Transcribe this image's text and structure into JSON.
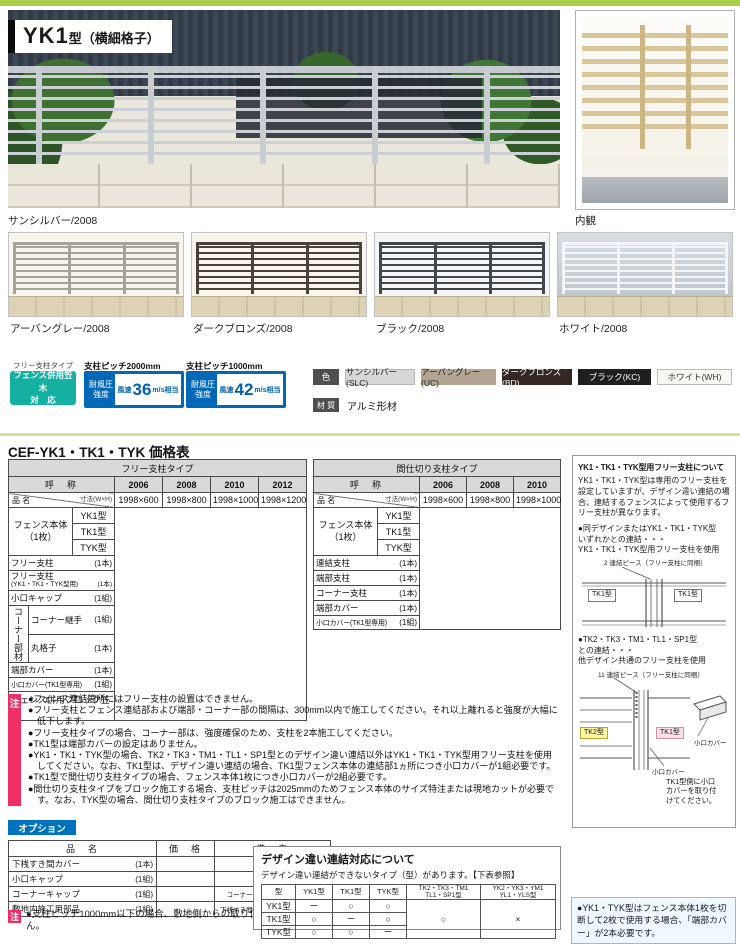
{
  "theme": {
    "top_bar_green": "#abce4b",
    "kasagi_teal": "#14b0a2",
    "wind_blue": "#0068b7",
    "note_red": "#ef2e63",
    "option_blue": "#0071bc",
    "kasagi_text_teal": "#00a3af"
  },
  "hero": {
    "model": "YK1",
    "model_suffix": "型（横細格子）",
    "caption": "サンシルバー/2008",
    "side_caption": "内観"
  },
  "variants": {
    "items": [
      {
        "label": "アーバングレー/2008"
      },
      {
        "label": "ダークブロンズ/2008"
      },
      {
        "label": "ブラック/2008"
      },
      {
        "label": "ホワイト/2008"
      }
    ]
  },
  "specs": {
    "free_post_type": "フリー支柱タイプ",
    "kasagi_badge": "フェンス併用笠木\n対　応",
    "wind": [
      {
        "pitch": "支柱ピッチ2000mm",
        "strength": "耐風圧\n強度",
        "prefix": "風速",
        "value": "36",
        "unit": "m/s相当"
      },
      {
        "pitch": "支柱ピッチ1000mm",
        "strength": "耐風圧\n強度",
        "prefix": "風速",
        "value": "42",
        "unit": "m/s相当"
      }
    ],
    "color_label": "色",
    "colors": [
      {
        "name": "サンシルバー(SLC)",
        "bg": "#d7d7d7",
        "fg": "#222222"
      },
      {
        "name": "アーバングレー(UC)",
        "bg": "#b3a591",
        "fg": "#222222"
      },
      {
        "name": "ダークブロンズ(BD)",
        "bg": "#332823",
        "fg": "#ffffff"
      },
      {
        "name": "ブラック(KC)",
        "bg": "#1f1f1f",
        "fg": "#ffffff"
      },
      {
        "name": "ホワイト(WH)",
        "bg": "#f7f7f3",
        "fg": "#333333"
      }
    ],
    "material_label": "材 質",
    "material_value": "アルミ形材"
  },
  "price": {
    "title": "CEF-YK1・TK1・TYK 価格表",
    "free": {
      "type_header": "フリー支柱タイプ",
      "name_header": "呼　称",
      "diag_top": "寸法(W×H)",
      "diag_bottom": "品 名",
      "years": [
        "2006",
        "2008",
        "2010",
        "2012"
      ],
      "sizes": [
        "1998×600",
        "1998×800",
        "1998×1000",
        "1998×1200"
      ],
      "body_label": "フェンス本体\n（1枚）",
      "body_rows": [
        "YK1型",
        "TK1型",
        "TYK型"
      ],
      "row_free_post": {
        "name": "フリー支柱",
        "qty": "(1本)"
      },
      "row_free_post2": {
        "name": "フリー支柱",
        "name2": "(YK1・TK1・TYK型用)",
        "qty": "(1本)"
      },
      "row_cap": {
        "name": "小口キャップ",
        "qty": "(1組)"
      },
      "corner_label": "コーナー部材",
      "corner_rows": [
        {
          "name": "コーナー継手",
          "qty": "(1組)"
        },
        {
          "name": "丸格子",
          "qty": "(1本)"
        }
      ],
      "row_end_cover": {
        "name": "端部カバー",
        "qty": "(1本)"
      },
      "row_kuchi_cover": {
        "name": "小口カバー(TK1型専用)",
        "qty": "(1組)"
      },
      "row_kasagi": "フェンス併用ブロック笠木"
    },
    "partition": {
      "type_header": "間仕切り支柱タイプ",
      "name_header": "呼　称",
      "diag_top": "寸法(W×H)",
      "diag_bottom": "品 名",
      "years": [
        "2006",
        "2008",
        "2010"
      ],
      "sizes": [
        "1998×600",
        "1998×800",
        "1998×1000"
      ],
      "body_label": "フェンス本体\n（1枚）",
      "body_rows": [
        "YK1型",
        "TK1型",
        "TYK型"
      ],
      "rows": [
        {
          "name": "連結支柱",
          "qty": "(1本)"
        },
        {
          "name": "端部支柱",
          "qty": "(1本)"
        },
        {
          "name": "コーナー支柱",
          "qty": "(1本)"
        },
        {
          "name": "端部カバー",
          "qty": "(1本)"
        },
        {
          "name": "小口カバー(TK1型専用)",
          "qty": "(1組)"
        }
      ]
    }
  },
  "sidebar": {
    "title": "YK1・TK1・TYK型用フリー支柱について",
    "body": "YK1・TK1・TYK型は専用のフリー支柱を設定していますが、デザイン違い連結の場合、連結するフェンスによって使用するフリー支柱が異なります。",
    "bullet1": "●同デザインまたはYK1・TK1・TYK型\nいずれかとの連結・・・\nYK1・TK1・TYK型用フリー支柱を使用",
    "d1_num": "2",
    "d1_label": "連結ピース（フリー支柱に同梱）",
    "d1_left": "TK1型",
    "d1_right": "TK1型",
    "bullet2": "●TK2・TK3・TM1・TL1・SP1型\nとの連結・・・\n他デザイン共通のフリー支柱を使用",
    "d2_num": "11",
    "d2_label": "連結ピース（フリー支柱に同梱）",
    "d2_left": "TK2型",
    "d2_right": "TK1型",
    "d2_cover1": "小口カバー",
    "d2_cover2": "小口カバー",
    "d2_note": "TK1型側に小口\nカバーを取り付\nけてください。"
  },
  "notes": {
    "badge": "注",
    "items": [
      "●フェンス連結箇所にはフリー支柱の設置はできません。",
      "●フリー支柱とフェンス連結部および端部・コーナー部の間隔は、300mm以内で施工してください。それ以上離れると強度が大幅に低下します。",
      "●フリー支柱タイプの場合、コーナー部は、強度確保のため、支柱を2本施工してください。",
      "●TK1型は端部カバーの設定はありません。",
      "●YK1・TK1・TYK型の場合、TK2・TK3・TM1・TL1・SP1型とのデザイン違い連結以外はYK1・TK1・TYK型用フリー支柱を使用してください。なお、TK1型は、デザイン違い連結の場合、TK1型フェンス本体の連結部1ヵ所につき小口カバーが1組必要です。",
      "●TK1型で間仕切り支柱タイプの場合、フェンス本体1枚につき小口カバーが2組必要です。",
      "●間仕切り支柱タイプをブロック施工する場合、支柱ピッチは2025mmのためフェンス本体のサイズ特注または現地カットが必要です。なお、TYK型の場合、間仕切り支柱タイプのブロック施工はできません。"
    ]
  },
  "options": {
    "badge": "オプション",
    "headers": [
      "品　名",
      "価　格",
      "備　考"
    ],
    "rows": [
      {
        "name": "下桟すき間カバー",
        "qty": "(1本)",
        "price": "",
        "remark": "L=1985"
      },
      {
        "name": "小口キャップ",
        "qty": "(1組)",
        "price": "",
        "remark": "2コ1組"
      },
      {
        "name": "コーナーキャップ",
        "qty": "(1組)",
        "price": "",
        "remark": "コーナー部1ヵ所につき1組必要"
      },
      {
        "name": "敷地内施工用部品",
        "qty": "(1組)",
        "price": "",
        "remark": "下桟すき間カバー1本につき1組必要"
      }
    ],
    "note_badge": "注",
    "note": "●支柱ピッチ1000mm以下の場合、敷地側からの取り付けはできません。"
  },
  "design": {
    "title": "デザイン違い連結対応について",
    "subtitle": "デザイン違い連結ができないタイプ（型）があります。【下表参照】",
    "headers": [
      "型",
      "YK1型",
      "TK1型",
      "TYK型",
      "TK2・TK3・TM1\nTL1・SP1型",
      "YK2・YK3・YM1\nYL1・YLS型"
    ],
    "rows": [
      [
        "YK1型",
        "ー",
        "○",
        "○"
      ],
      [
        "TK1型",
        "○",
        "ー",
        "○"
      ],
      [
        "TYK型",
        "○",
        "○",
        "ー"
      ]
    ],
    "merged": [
      "○",
      "×"
    ]
  },
  "footnote": "●YK1・TYK型はフェンス本体1枚を切断して2枚で使用する場合、「端部カバー」が2本必要です。"
}
